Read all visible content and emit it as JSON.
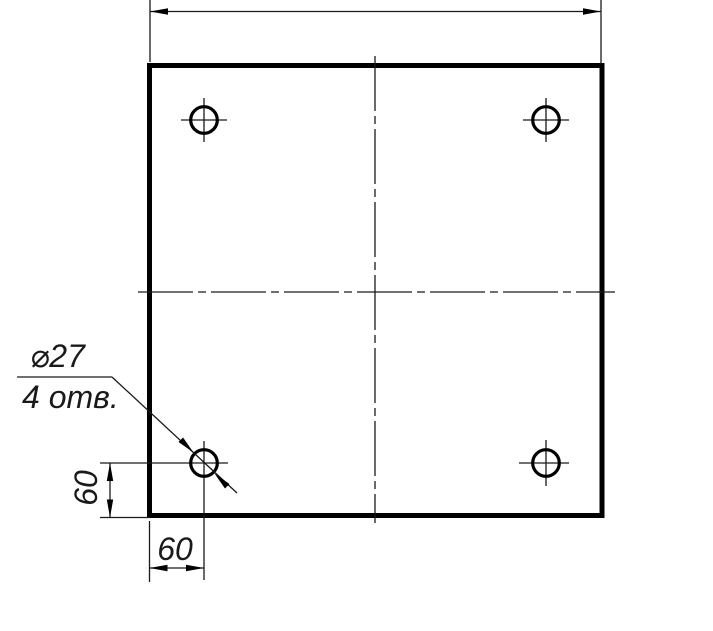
{
  "drawing": {
    "kind": "engineering-drawing-plate-with-holes",
    "colors": {
      "line": "#000000",
      "background": "#ffffff"
    },
    "callout": {
      "diameter": "⌀27",
      "count": "4 отв."
    },
    "dimensions": {
      "left_offset": "60",
      "bottom_offset": "60"
    },
    "hole_count": 4
  }
}
